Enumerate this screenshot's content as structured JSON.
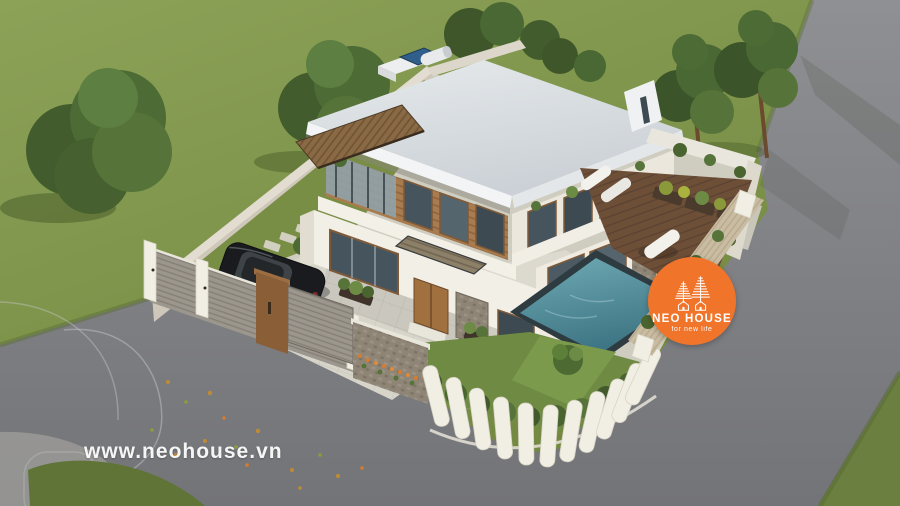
{
  "logo": {
    "name": "NEO HOUSE",
    "tagline": "for new life",
    "icon": "twin-trees-houses-icon"
  },
  "watermark": {
    "text": "www.neohouse.vn"
  },
  "colors": {
    "logo_orange": "#F0752B",
    "watermark_white": "#FFFFFF",
    "grass": "#7E9349",
    "grass_dark": "#64783C",
    "road": "#808186",
    "roof": "#D3D8DC",
    "wall_white": "#F2EFE7",
    "wall_beige": "#CFC8BA",
    "wood": "#A97C4F",
    "stone": "#8F8576",
    "deck_wood": "#6D4F38",
    "pool_teal": "#4A8493",
    "fence_grey": "#9C978E",
    "fence_white": "#F1EEE3",
    "hedge_green": "#4A642F",
    "car_black": "#1A1C1F",
    "solar_blue": "#2F5F8A",
    "flower_orange": "#D97B2E"
  },
  "scene": {
    "labels": {
      "house": "modern-two-storey-villa",
      "pool": "swimming-pool",
      "deck": "wooden-pool-deck",
      "car": "black-sedan",
      "driveway": "paved-driveway",
      "gate": "wooden-gate-pillar",
      "fence": "perimeter-fence",
      "road": "asphalt-road",
      "lawn": "surrounding-lawn",
      "trees": "garden-trees",
      "solar_heater": "rooftop-solar-water-heater"
    }
  }
}
